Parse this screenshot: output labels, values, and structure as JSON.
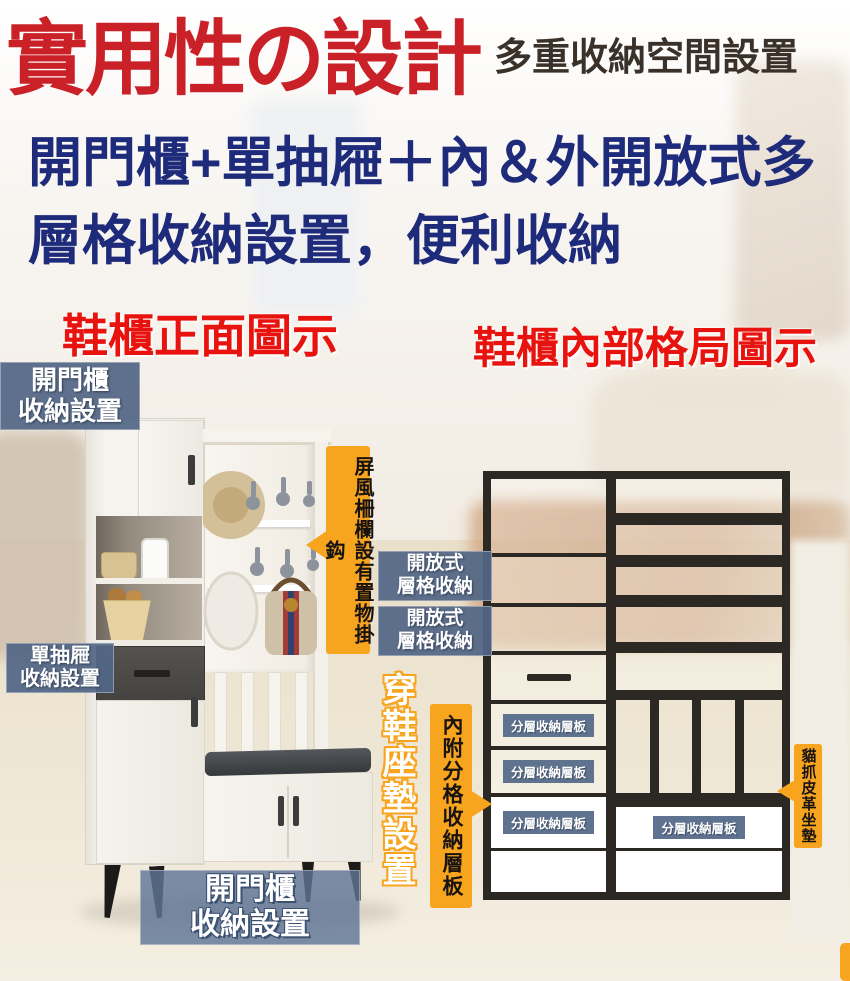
{
  "header": {
    "title": "實用性の設計",
    "subtitle": "多重收納空間設置"
  },
  "intro": {
    "line1": "開門櫃+單抽屜＋內＆外開放式多",
    "line2": "層格收納設置，便利收納"
  },
  "sections": {
    "front_title": "鞋櫃正面圖示",
    "interior_title": "鞋櫃內部格局圖示"
  },
  "callouts": {
    "top_door": {
      "line1": "開門櫃",
      "line2": "收納設置"
    },
    "drawer": {
      "line1": "單抽屜",
      "line2": "收納設置"
    },
    "open_shelf_1": {
      "line1": "開放式",
      "line2": "層格收納"
    },
    "open_shelf_2": {
      "line1": "開放式",
      "line2": "層格收納"
    },
    "screen_hooks": "屏風柵欄設有置物掛鈎",
    "seat_cushion": "穿鞋座墊設置",
    "divided_shelf": "內附分格收納層板",
    "cat_leather_seat": "貓抓皮革坐墊",
    "bottom_door": {
      "line1": "開門櫃",
      "line2": "收納設置"
    }
  },
  "diagram": {
    "shelf_labels": [
      "分層收納層板",
      "分層收納層板",
      "分層收納層板",
      "分層收納層板"
    ]
  },
  "colors": {
    "title_red": "#c92127",
    "section_red": "#e8120e",
    "navy_text": "#1e2a7a",
    "label_blue": "#526685",
    "callout_orange": "#f7a41f",
    "frame_black": "#2c2824"
  }
}
